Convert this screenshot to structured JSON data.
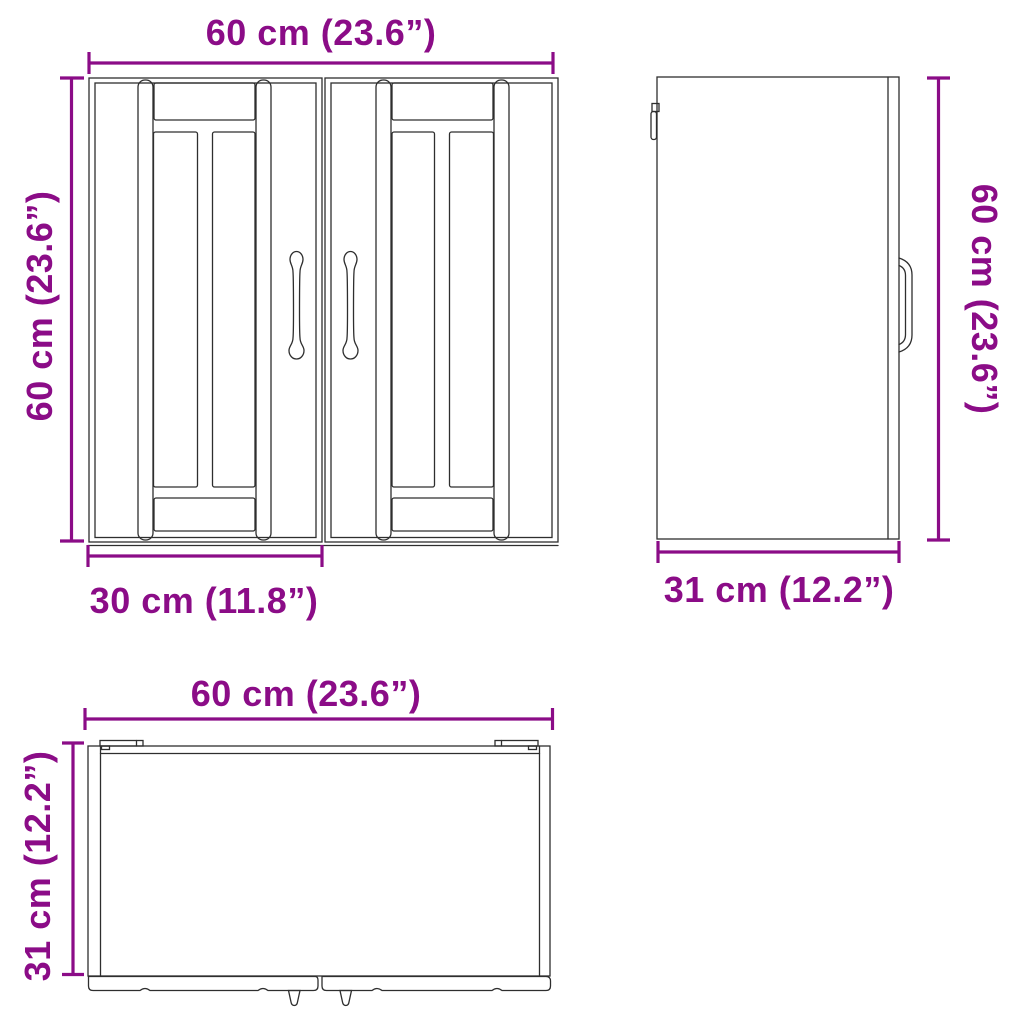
{
  "colors": {
    "dimension_accent": "#8B0C87",
    "line_art": "#2e2e2e",
    "background": "#ffffff"
  },
  "front_view": {
    "width_label": "60 cm (23.6”)",
    "height_label": "60 cm (23.6”)",
    "door_width_label": "30 cm (11.8”)"
  },
  "side_view": {
    "height_label": "60 cm (23.6”)",
    "depth_label": "31 cm (12.2”)"
  },
  "top_view": {
    "width_label": "60 cm (23.6”)",
    "depth_label": "31 cm (12.2”)"
  }
}
